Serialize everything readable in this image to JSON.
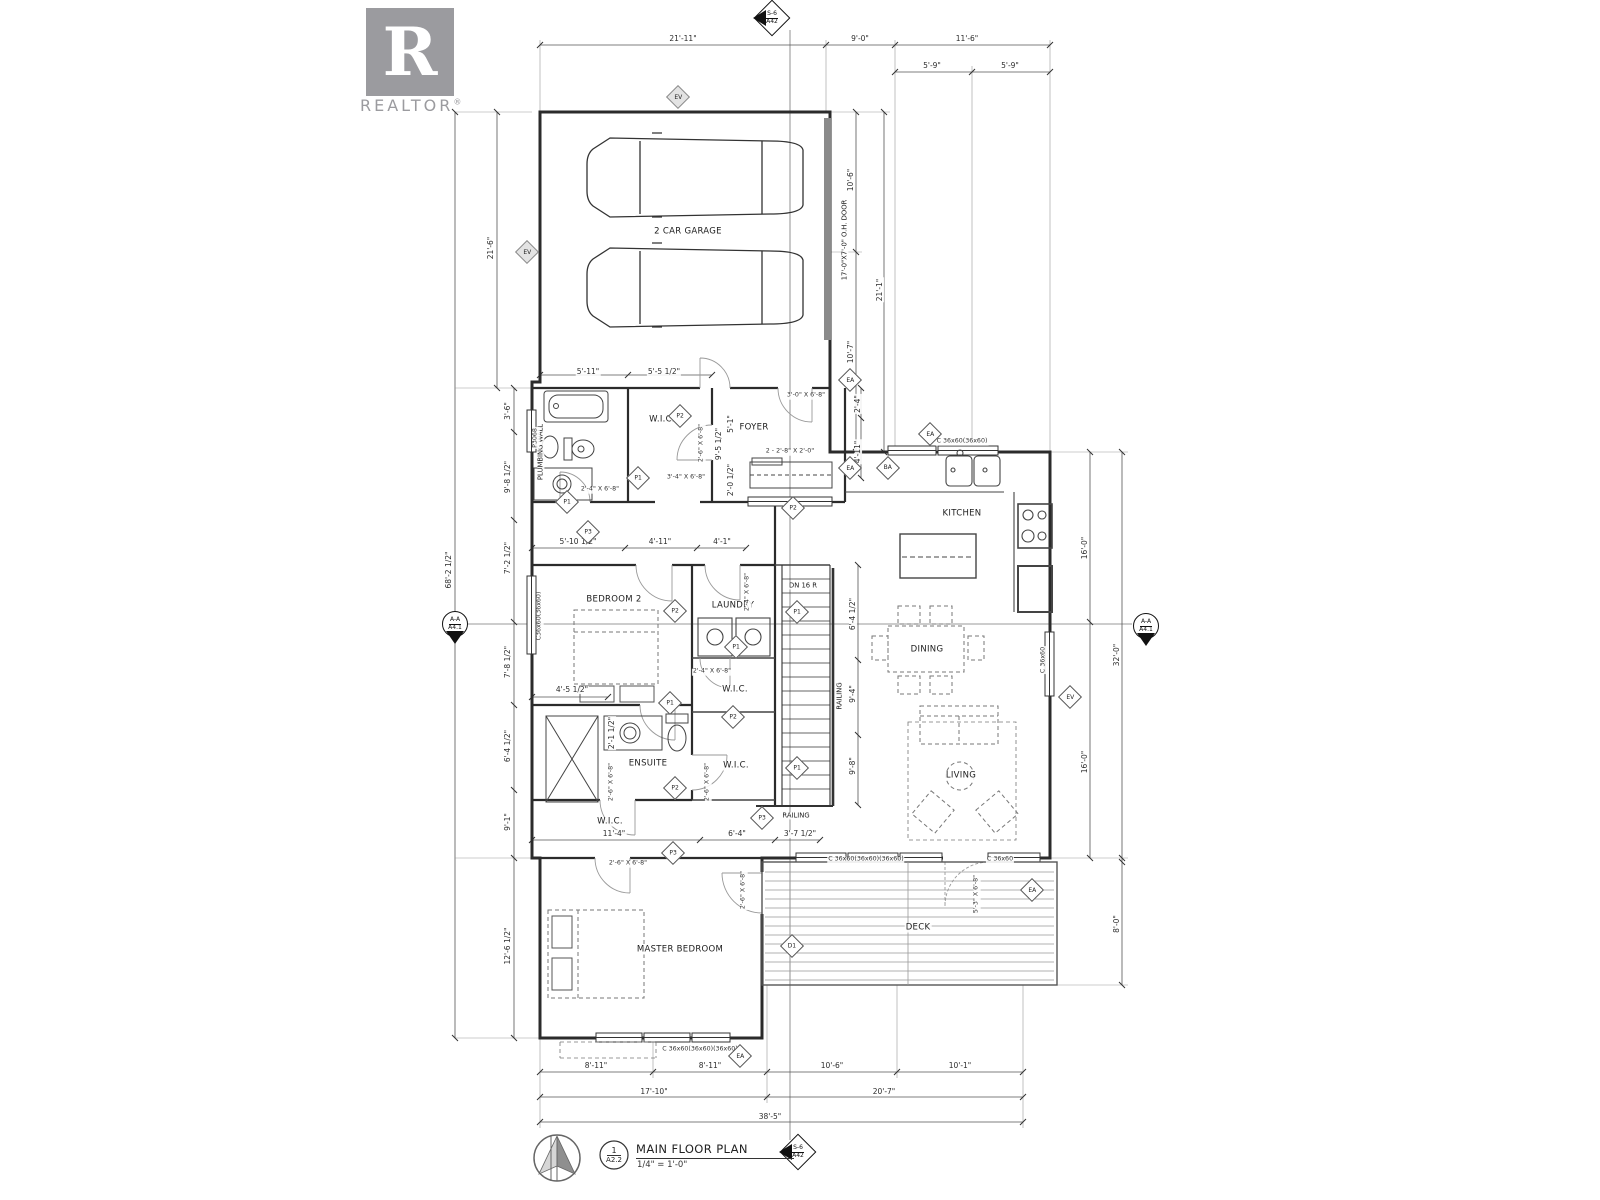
{
  "logo": {
    "letter": "R",
    "wordmark": "REALTOR",
    "registered": "®"
  },
  "title_block": {
    "detail_number": "1",
    "detail_sheet": "A2.2",
    "title": "MAIN FLOOR PLAN",
    "scale": "1/4\" = 1'-0\""
  },
  "colors": {
    "paper": "#ffffff",
    "line": "#2b2b2b",
    "dim_line": "#555555",
    "logo_gray": "#9b9b9f"
  },
  "section_markers": [
    {
      "label": "S-6",
      "sheet": "A42",
      "x": 772,
      "y": 18,
      "shape": "diamond",
      "arrow": "left"
    },
    {
      "label": "S-6",
      "sheet": "A42",
      "x": 798,
      "y": 1152,
      "shape": "diamond",
      "arrow": "left"
    },
    {
      "label": "A-A",
      "sheet": "A4.1",
      "x": 455,
      "y": 624,
      "shape": "circle",
      "arrow": "down"
    },
    {
      "label": "A-A",
      "sheet": "A4.1",
      "x": 1146,
      "y": 626,
      "shape": "circle",
      "arrow": "down"
    }
  ],
  "rooms": [
    {
      "text": "2 CAR GARAGE",
      "x": 688,
      "y": 232
    },
    {
      "text": "FOYER",
      "x": 754,
      "y": 428
    },
    {
      "text": "W.I.C.",
      "x": 662,
      "y": 420
    },
    {
      "text": "KITCHEN",
      "x": 962,
      "y": 514
    },
    {
      "text": "DINING",
      "x": 927,
      "y": 650
    },
    {
      "text": "LIVING",
      "x": 961,
      "y": 776
    },
    {
      "text": "BEDROOM 2",
      "x": 614,
      "y": 600
    },
    {
      "text": "LAUNDRY",
      "x": 733,
      "y": 606
    },
    {
      "text": "W.I.C.",
      "x": 735,
      "y": 690
    },
    {
      "text": "W.I.C.",
      "x": 736,
      "y": 766
    },
    {
      "text": "ENSUITE",
      "x": 648,
      "y": 764
    },
    {
      "text": "W.I.C.",
      "x": 610,
      "y": 822
    },
    {
      "text": "MASTER BEDROOM",
      "x": 680,
      "y": 950
    },
    {
      "text": "DECK",
      "x": 918,
      "y": 928
    }
  ],
  "annotations": [
    {
      "text": "PLUMBING WALL",
      "x": 541,
      "y": 452,
      "rot": -90
    },
    {
      "text": "17'-0\"X7'-0\" O.H. DOOR",
      "x": 845,
      "y": 240,
      "rot": -90
    },
    {
      "text": "DN 16 R",
      "x": 803,
      "y": 586
    },
    {
      "text": "RAILING",
      "x": 840,
      "y": 696,
      "rot": -90
    },
    {
      "text": "RAILING",
      "x": 796,
      "y": 816
    }
  ],
  "dimensions": [
    {
      "text": "21'-11\"",
      "x": 683,
      "y": 39
    },
    {
      "text": "9'-0\"",
      "x": 860,
      "y": 39
    },
    {
      "text": "11'-6\"",
      "x": 967,
      "y": 39
    },
    {
      "text": "5'-9\"",
      "x": 932,
      "y": 66
    },
    {
      "text": "5'-9\"",
      "x": 1010,
      "y": 66
    },
    {
      "text": "21'-6\"",
      "x": 491,
      "y": 248,
      "rot": -90
    },
    {
      "text": "68'-2 1/2\"",
      "x": 449,
      "y": 570,
      "rot": -90
    },
    {
      "text": "3'-6\"",
      "x": 508,
      "y": 411,
      "rot": -90
    },
    {
      "text": "9'-8 1/2\"",
      "x": 508,
      "y": 477,
      "rot": -90
    },
    {
      "text": "7'-2 1/2\"",
      "x": 508,
      "y": 558,
      "rot": -90
    },
    {
      "text": "7'-8 1/2\"",
      "x": 508,
      "y": 662,
      "rot": -90
    },
    {
      "text": "6'-4 1/2\"",
      "x": 508,
      "y": 746,
      "rot": -90
    },
    {
      "text": "9'-1\"",
      "x": 508,
      "y": 822,
      "rot": -90
    },
    {
      "text": "12'-6 1/2\"",
      "x": 508,
      "y": 946,
      "rot": -90
    },
    {
      "text": "10'-6\"",
      "x": 851,
      "y": 180,
      "rot": -90
    },
    {
      "text": "10'-7\"",
      "x": 851,
      "y": 352,
      "rot": -90
    },
    {
      "text": "21'-1\"",
      "x": 880,
      "y": 290,
      "rot": -90
    },
    {
      "text": "16'-0\"",
      "x": 1085,
      "y": 548,
      "rot": -90
    },
    {
      "text": "16'-0\"",
      "x": 1085,
      "y": 762,
      "rot": -90
    },
    {
      "text": "32'-0\"",
      "x": 1117,
      "y": 655,
      "rot": -90
    },
    {
      "text": "8'-0\"",
      "x": 1117,
      "y": 924,
      "rot": -90
    },
    {
      "text": "8'-11\"",
      "x": 596,
      "y": 1066
    },
    {
      "text": "8'-11\"",
      "x": 710,
      "y": 1066
    },
    {
      "text": "10'-6\"",
      "x": 832,
      "y": 1066
    },
    {
      "text": "10'-1\"",
      "x": 960,
      "y": 1066
    },
    {
      "text": "17'-10\"",
      "x": 654,
      "y": 1092
    },
    {
      "text": "20'-7\"",
      "x": 884,
      "y": 1092
    },
    {
      "text": "38'-5\"",
      "x": 770,
      "y": 1117
    },
    {
      "text": "5'-11\"",
      "x": 588,
      "y": 372
    },
    {
      "text": "5'-5 1/2\"",
      "x": 664,
      "y": 372
    },
    {
      "text": "9'-5 1/2\"",
      "x": 719,
      "y": 444,
      "rot": -90
    },
    {
      "text": "5'-1\"",
      "x": 731,
      "y": 424,
      "rot": -90
    },
    {
      "text": "2'-0 1/2\"",
      "x": 731,
      "y": 480,
      "rot": -90
    },
    {
      "text": "2'-4\"",
      "x": 858,
      "y": 404,
      "rot": -90
    },
    {
      "text": "4'-11\"",
      "x": 858,
      "y": 452,
      "rot": -90
    },
    {
      "text": "5'-10 1/2\"",
      "x": 578,
      "y": 542
    },
    {
      "text": "4'-11\"",
      "x": 660,
      "y": 542
    },
    {
      "text": "4'-1\"",
      "x": 722,
      "y": 542
    },
    {
      "text": "4'-5 1/2\"",
      "x": 572,
      "y": 690
    },
    {
      "text": "2'-1 1/2\"",
      "x": 612,
      "y": 733,
      "rot": -90
    },
    {
      "text": "11'-4\"",
      "x": 614,
      "y": 834
    },
    {
      "text": "6'-4\"",
      "x": 737,
      "y": 834
    },
    {
      "text": "3'-7 1/2\"",
      "x": 800,
      "y": 834
    },
    {
      "text": "6'-4 1/2\"",
      "x": 853,
      "y": 614,
      "rot": -90
    },
    {
      "text": "9'-4\"",
      "x": 853,
      "y": 694,
      "rot": -90
    },
    {
      "text": "9'-8\"",
      "x": 853,
      "y": 766,
      "rot": -90
    }
  ],
  "openings": [
    {
      "text": "3'-0\" X 6'-8\"",
      "x": 806,
      "y": 396
    },
    {
      "text": "2 - 2'-8\" X 2'-0\"",
      "x": 790,
      "y": 452
    },
    {
      "text": "2'-6\" X 6'-8\"",
      "x": 702,
      "y": 443,
      "rot": -90
    },
    {
      "text": "3'-4\" X 6'-8\"",
      "x": 686,
      "y": 478
    },
    {
      "text": "2'-4\" X 6'-8\"",
      "x": 600,
      "y": 490
    },
    {
      "text": "P3068",
      "x": 536,
      "y": 438,
      "rot": -90
    },
    {
      "text": "C36x60(36x60)",
      "x": 540,
      "y": 616,
      "rot": -90
    },
    {
      "text": "2'-4\" X 6'-8\"",
      "x": 748,
      "y": 592,
      "rot": -90
    },
    {
      "text": "2'-4\" X 6'-8\"",
      "x": 712,
      "y": 672
    },
    {
      "text": "2'-6\" X 6'-8\"",
      "x": 612,
      "y": 782,
      "rot": -90
    },
    {
      "text": "2'-6\" X 6'-8\"",
      "x": 708,
      "y": 782,
      "rot": -90
    },
    {
      "text": "2'-6\" X 6'-8\"",
      "x": 628,
      "y": 864
    },
    {
      "text": "2'-6\" X 6'-8\"",
      "x": 744,
      "y": 890,
      "rot": -90
    },
    {
      "text": "C 36x60(36x60)(36x60)",
      "x": 700,
      "y": 1050
    },
    {
      "text": "C 36x60(36x60)(36x60)",
      "x": 866,
      "y": 860
    },
    {
      "text": "C 36x60",
      "x": 1000,
      "y": 860
    },
    {
      "text": "5'-3\" X 6'-8\"",
      "x": 977,
      "y": 894,
      "rot": -90
    },
    {
      "text": "C 36x60",
      "x": 1044,
      "y": 660,
      "rot": -90
    },
    {
      "text": "C 36x60(36x60)",
      "x": 962,
      "y": 442
    }
  ],
  "keynotes": [
    {
      "text": "EV",
      "x": 678,
      "y": 97,
      "variant": "gray"
    },
    {
      "text": "EV",
      "x": 527,
      "y": 252,
      "variant": "gray"
    },
    {
      "text": "EA",
      "x": 850,
      "y": 380
    },
    {
      "text": "EA",
      "x": 850,
      "y": 468
    },
    {
      "text": "BA",
      "x": 888,
      "y": 468
    },
    {
      "text": "EA",
      "x": 930,
      "y": 434
    },
    {
      "text": "EV",
      "x": 1070,
      "y": 697
    },
    {
      "text": "EA",
      "x": 740,
      "y": 1056
    },
    {
      "text": "D1",
      "x": 792,
      "y": 946
    },
    {
      "text": "EA",
      "x": 1032,
      "y": 890
    },
    {
      "text": "P2",
      "x": 680,
      "y": 416
    },
    {
      "text": "P1",
      "x": 638,
      "y": 478
    },
    {
      "text": "P1",
      "x": 567,
      "y": 502
    },
    {
      "text": "P3",
      "x": 588,
      "y": 532
    },
    {
      "text": "P2",
      "x": 793,
      "y": 508
    },
    {
      "text": "P2",
      "x": 675,
      "y": 611
    },
    {
      "text": "P1",
      "x": 797,
      "y": 612
    },
    {
      "text": "P1",
      "x": 736,
      "y": 647
    },
    {
      "text": "P1",
      "x": 670,
      "y": 703
    },
    {
      "text": "P2",
      "x": 733,
      "y": 717
    },
    {
      "text": "P2",
      "x": 675,
      "y": 788
    },
    {
      "text": "P3",
      "x": 762,
      "y": 818
    },
    {
      "text": "P1",
      "x": 797,
      "y": 768
    },
    {
      "text": "P3",
      "x": 673,
      "y": 853
    }
  ]
}
